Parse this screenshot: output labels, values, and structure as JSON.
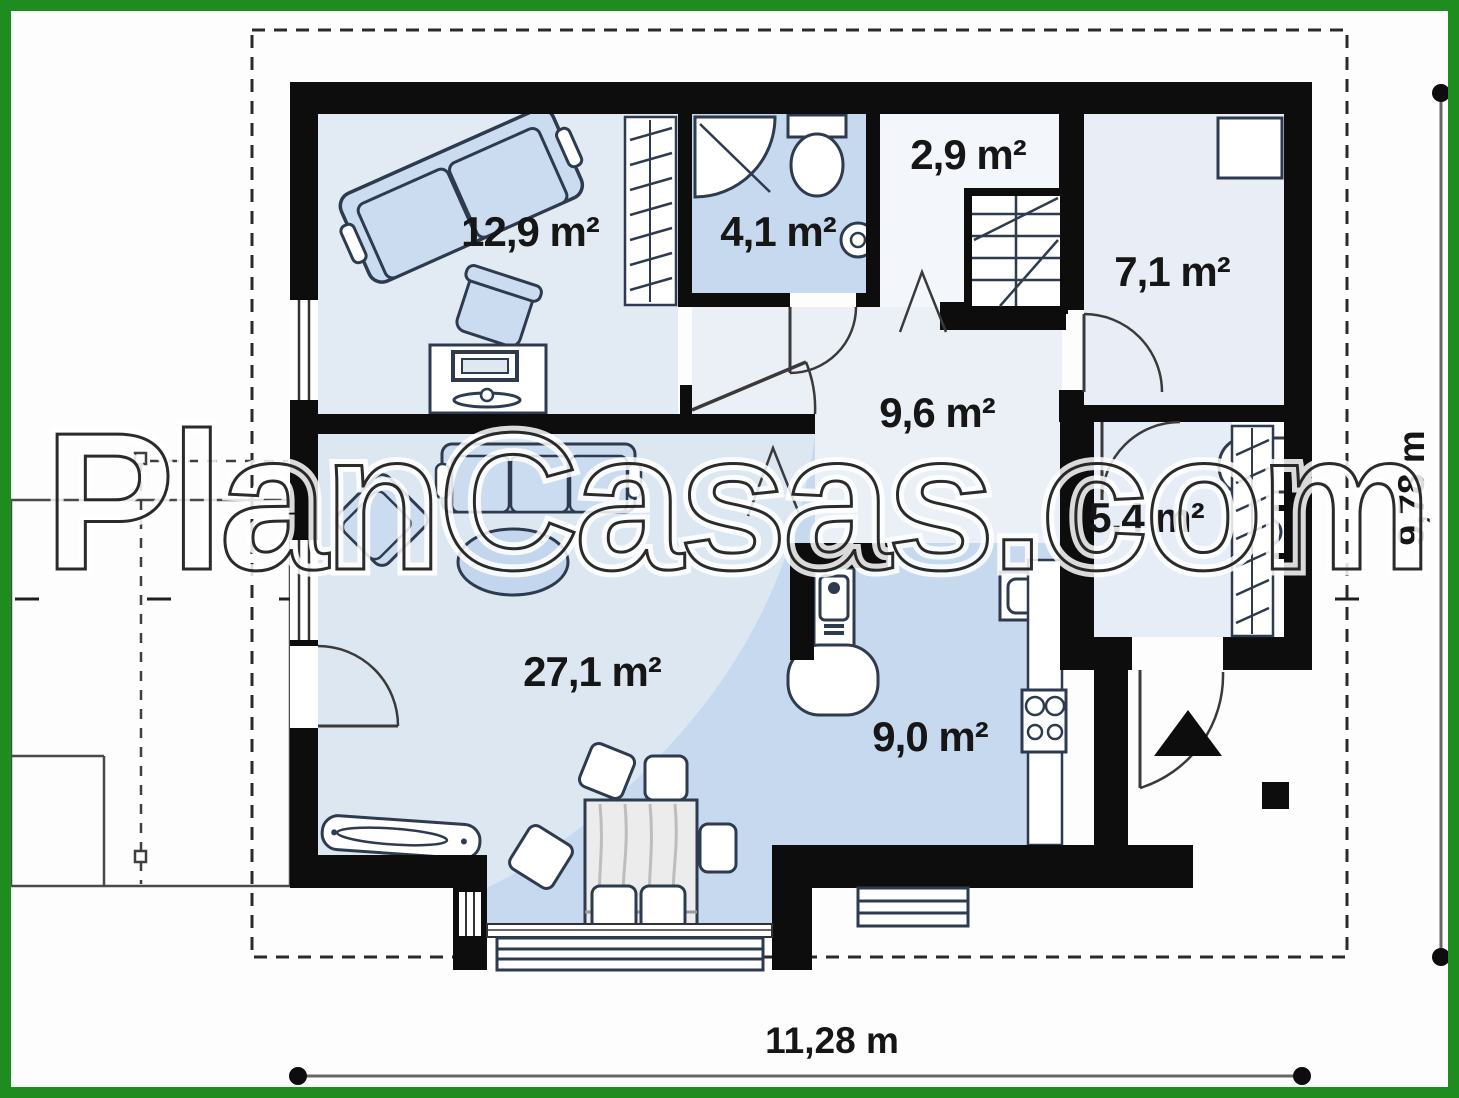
{
  "image": {
    "width": 1459,
    "height": 1098
  },
  "watermark": {
    "text": "PlanCasas.com"
  },
  "rooms": [
    {
      "id": "bedroom",
      "area_label": "12,9 m²"
    },
    {
      "id": "bathroom",
      "area_label": "4,1 m²"
    },
    {
      "id": "stair_hall",
      "area_label": "2,9 m²"
    },
    {
      "id": "utility_room",
      "area_label": "7,1 m²"
    },
    {
      "id": "central_hall",
      "area_label": "9,6 m²"
    },
    {
      "id": "entry_hall",
      "area_label": "5,4 m²"
    },
    {
      "id": "living_room",
      "area_label": "27,1 m²"
    },
    {
      "id": "kitchen",
      "area_label": "9,0 m²"
    }
  ],
  "dimensions": {
    "width_label": "11,28 m",
    "height_label": "9,78 m"
  },
  "colors": {
    "frame_green": "#1e8c1e",
    "wall_black": "#0d0d0d",
    "room_blue": "#c7d9ee",
    "room_light_blue": "#e2eaf4",
    "room_pale": "#ebf0f7",
    "living_fill": "#dde7f2",
    "furniture_blue": "#ccdcf0",
    "line_gray": "#3a3a3a"
  }
}
